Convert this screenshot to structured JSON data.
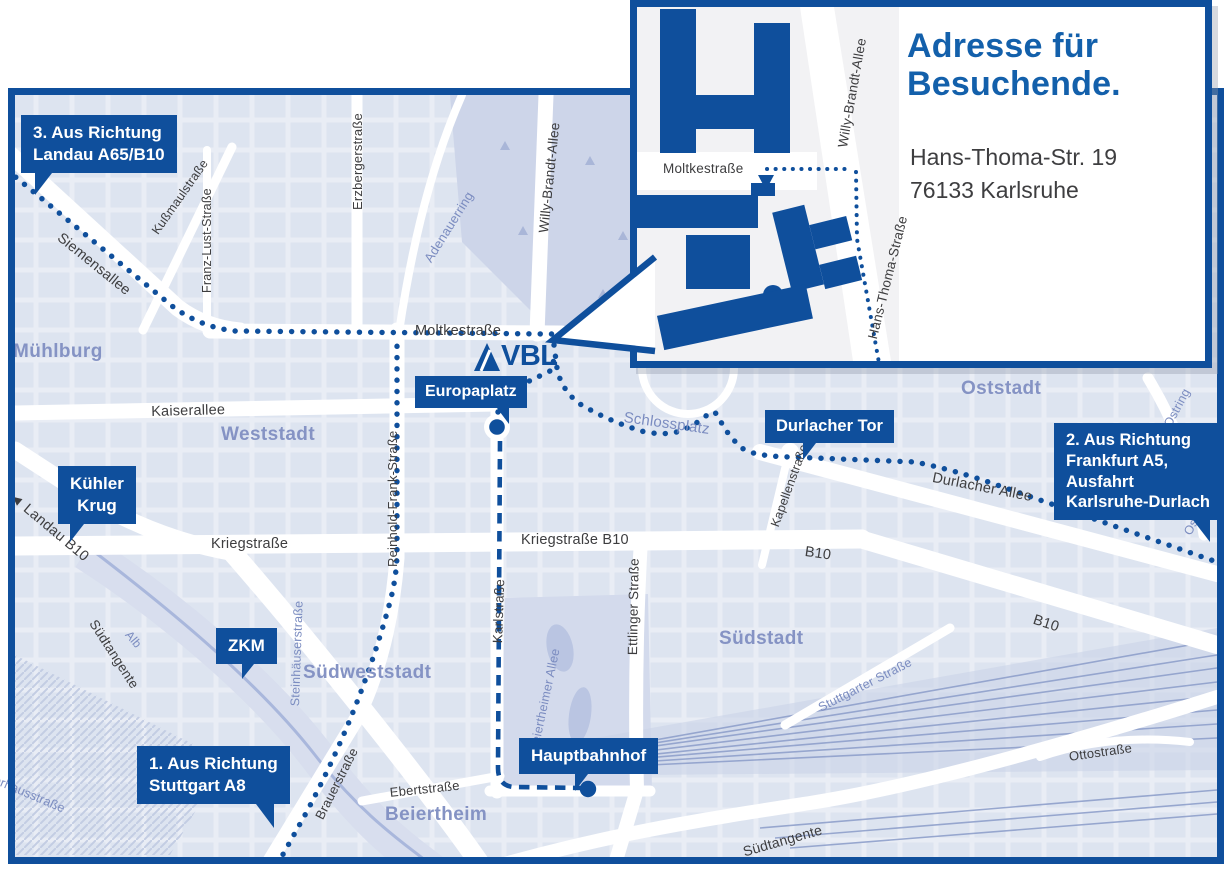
{
  "colors": {
    "primary_blue": "#0f4f9c",
    "title_blue": "#1360ab",
    "district_blue": "#8593c4",
    "street_dark": "#3d3d3f",
    "street_blue": "#7b8cc0",
    "map_base": "#e9edf5",
    "blocks": "#dbe2ef",
    "park": "#cdd5e9",
    "road_white": "#ffffff"
  },
  "logo": {
    "name": "VBL"
  },
  "inset": {
    "title": "Adresse für\nBesuchende.",
    "address": "Hans-Thoma-Str. 19\n76133 Karlsruhe",
    "streets": {
      "moltkestrasse": "Moltkestraße",
      "willy_brandt_allee": "Willy-Brandt-Allee",
      "hans_thoma_strasse": "Hans-Thoma-Straße"
    }
  },
  "badges": [
    {
      "id": "landau",
      "text": "3. Aus Richtung\nLandau A65/B10"
    },
    {
      "id": "frankfurt",
      "text": "2. Aus Richtung\nFrankfurt A5,\nAusfahrt\nKarlsruhe-Durlach"
    },
    {
      "id": "stuttgart",
      "text": "1. Aus Richtung\nStuttgart A8"
    },
    {
      "id": "kuehler_krug",
      "text": "Kühler\nKrug"
    },
    {
      "id": "zkm",
      "text": "ZKM"
    },
    {
      "id": "europaplatz",
      "text": "Europaplatz"
    },
    {
      "id": "durlacher_tor",
      "text": "Durlacher Tor"
    },
    {
      "id": "hauptbahnhof",
      "text": "Hauptbahnhof"
    }
  ],
  "districts": [
    "Mühlburg",
    "Weststadt",
    "Oststadt",
    "Südstadt",
    "Südweststadt",
    "Beiertheim"
  ],
  "streets": [
    "Siemensallee",
    "Kußmaulstraße",
    "Franz-Lust-Straße",
    "Erzbergerstraße",
    "Adenauerring",
    "Willy-Brandt-Allee",
    "Moltkestraße",
    "Kaiserallee",
    "Kriegstraße",
    "Kriegstraße B10",
    "Reinhold-Frank-Straße",
    "Karlstraße",
    "Ettlinger Straße",
    "Durlacher Allee",
    "Kapellenstraße",
    "B10",
    "B10",
    "◄ Landau B10",
    "Südtangente",
    "Südtangente",
    "Brauerstraße",
    "Ebertstraße",
    "Steinhäuserstraße",
    "Beiertheimer Allee",
    "Stuttgarter Straße",
    "Ottostraße",
    "Ostring",
    "Ostring",
    "Schlossplatz",
    "Alb",
    "Pulverhausstraße"
  ]
}
